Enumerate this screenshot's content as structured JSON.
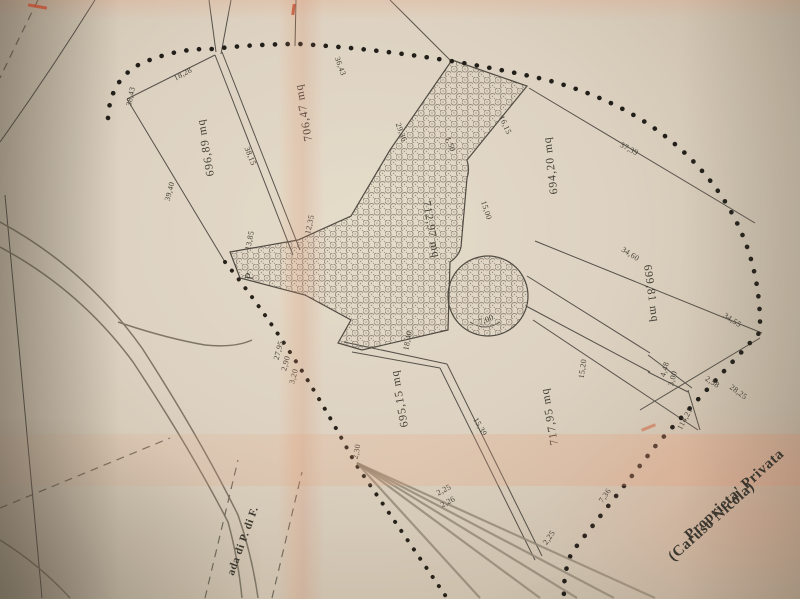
{
  "colors": {
    "paper": "#d8cfc1",
    "line": "#54504a",
    "boundary_dots": "#211e1a",
    "red_mark": "#c63e1e"
  },
  "plan": {
    "area_labels": [
      {
        "text": "706,47  mq",
        "x": 307,
        "y": 112,
        "r": -100
      },
      {
        "text": "696,89  mq",
        "x": 209,
        "y": 147,
        "r": -100
      },
      {
        "text": "694,20  mq",
        "x": 554,
        "y": 165,
        "r": -97
      },
      {
        "text": "699,81  mq",
        "x": 648,
        "y": 294,
        "r": 82
      },
      {
        "text": "712,97  mq",
        "x": 428,
        "y": 230,
        "r": 80
      },
      {
        "text": "695,15  mq",
        "x": 403,
        "y": 398,
        "r": -100
      },
      {
        "text": "717,95  mq",
        "x": 553,
        "y": 416,
        "r": -100
      }
    ],
    "dimension_labels": [
      {
        "text": "38,43",
        "x": 133,
        "y": 97,
        "r": -78
      },
      {
        "text": "18,28",
        "x": 184,
        "y": 76,
        "r": -28
      },
      {
        "text": "36,43",
        "x": 338,
        "y": 67,
        "r": 70
      },
      {
        "text": "38,15",
        "x": 248,
        "y": 157,
        "r": 68
      },
      {
        "text": "39,40",
        "x": 172,
        "y": 192,
        "r": -75
      },
      {
        "text": "29,36",
        "x": 399,
        "y": 133,
        "r": 70
      },
      {
        "text": "16,15",
        "x": 503,
        "y": 126,
        "r": 65
      },
      {
        "text": "1,50",
        "x": 448,
        "y": 145,
        "r": 70
      },
      {
        "text": "15,00",
        "x": 484,
        "y": 211,
        "r": 72
      },
      {
        "text": "37,39",
        "x": 628,
        "y": 151,
        "r": 28
      },
      {
        "text": "34,60",
        "x": 629,
        "y": 256,
        "r": 33
      },
      {
        "text": "34,55",
        "x": 731,
        "y": 322,
        "r": 33
      },
      {
        "text": "13,85",
        "x": 252,
        "y": 241,
        "r": -78
      },
      {
        "text": "12,35",
        "x": 312,
        "y": 225,
        "r": -78
      },
      {
        "text": "27,95",
        "x": 281,
        "y": 351,
        "r": -75
      },
      {
        "text": "2,90",
        "x": 288,
        "y": 364,
        "r": -75
      },
      {
        "text": "3,20",
        "x": 296,
        "y": 377,
        "r": -75
      },
      {
        "text": "18,40",
        "x": 410,
        "y": 341,
        "r": -80
      },
      {
        "text": "15,20",
        "x": 585,
        "y": 369,
        "r": -82
      },
      {
        "text": "15,39",
        "x": 478,
        "y": 428,
        "r": 60
      },
      {
        "text": "4,48",
        "x": 667,
        "y": 370,
        "r": -75
      },
      {
        "text": "3,00",
        "x": 675,
        "y": 379,
        "r": -75
      },
      {
        "text": "2,58",
        "x": 711,
        "y": 384,
        "r": 33
      },
      {
        "text": "114,21",
        "x": 687,
        "y": 420,
        "r": -62
      },
      {
        "text": "28,25",
        "x": 737,
        "y": 394,
        "r": 36
      },
      {
        "text": "7,36",
        "x": 607,
        "y": 497,
        "r": -55
      },
      {
        "text": "2,25",
        "x": 551,
        "y": 539,
        "r": -55
      },
      {
        "text": "2,25",
        "x": 445,
        "y": 492,
        "r": -28
      },
      {
        "text": "2,26",
        "x": 449,
        "y": 504,
        "r": -28
      },
      {
        "text": "2,30",
        "x": 359,
        "y": 452,
        "r": -80
      },
      {
        "text": "7,00",
        "x": 487,
        "y": 322,
        "r": -20
      }
    ],
    "markers": [
      {
        "text": "P",
        "x": 253,
        "y": 277,
        "r": -80
      }
    ],
    "annotations": {
      "owner_line1": "Proprieta' Privata",
      "owner_line2": "(Caruso Nicola)",
      "road_label": "ada di P. di F."
    }
  }
}
